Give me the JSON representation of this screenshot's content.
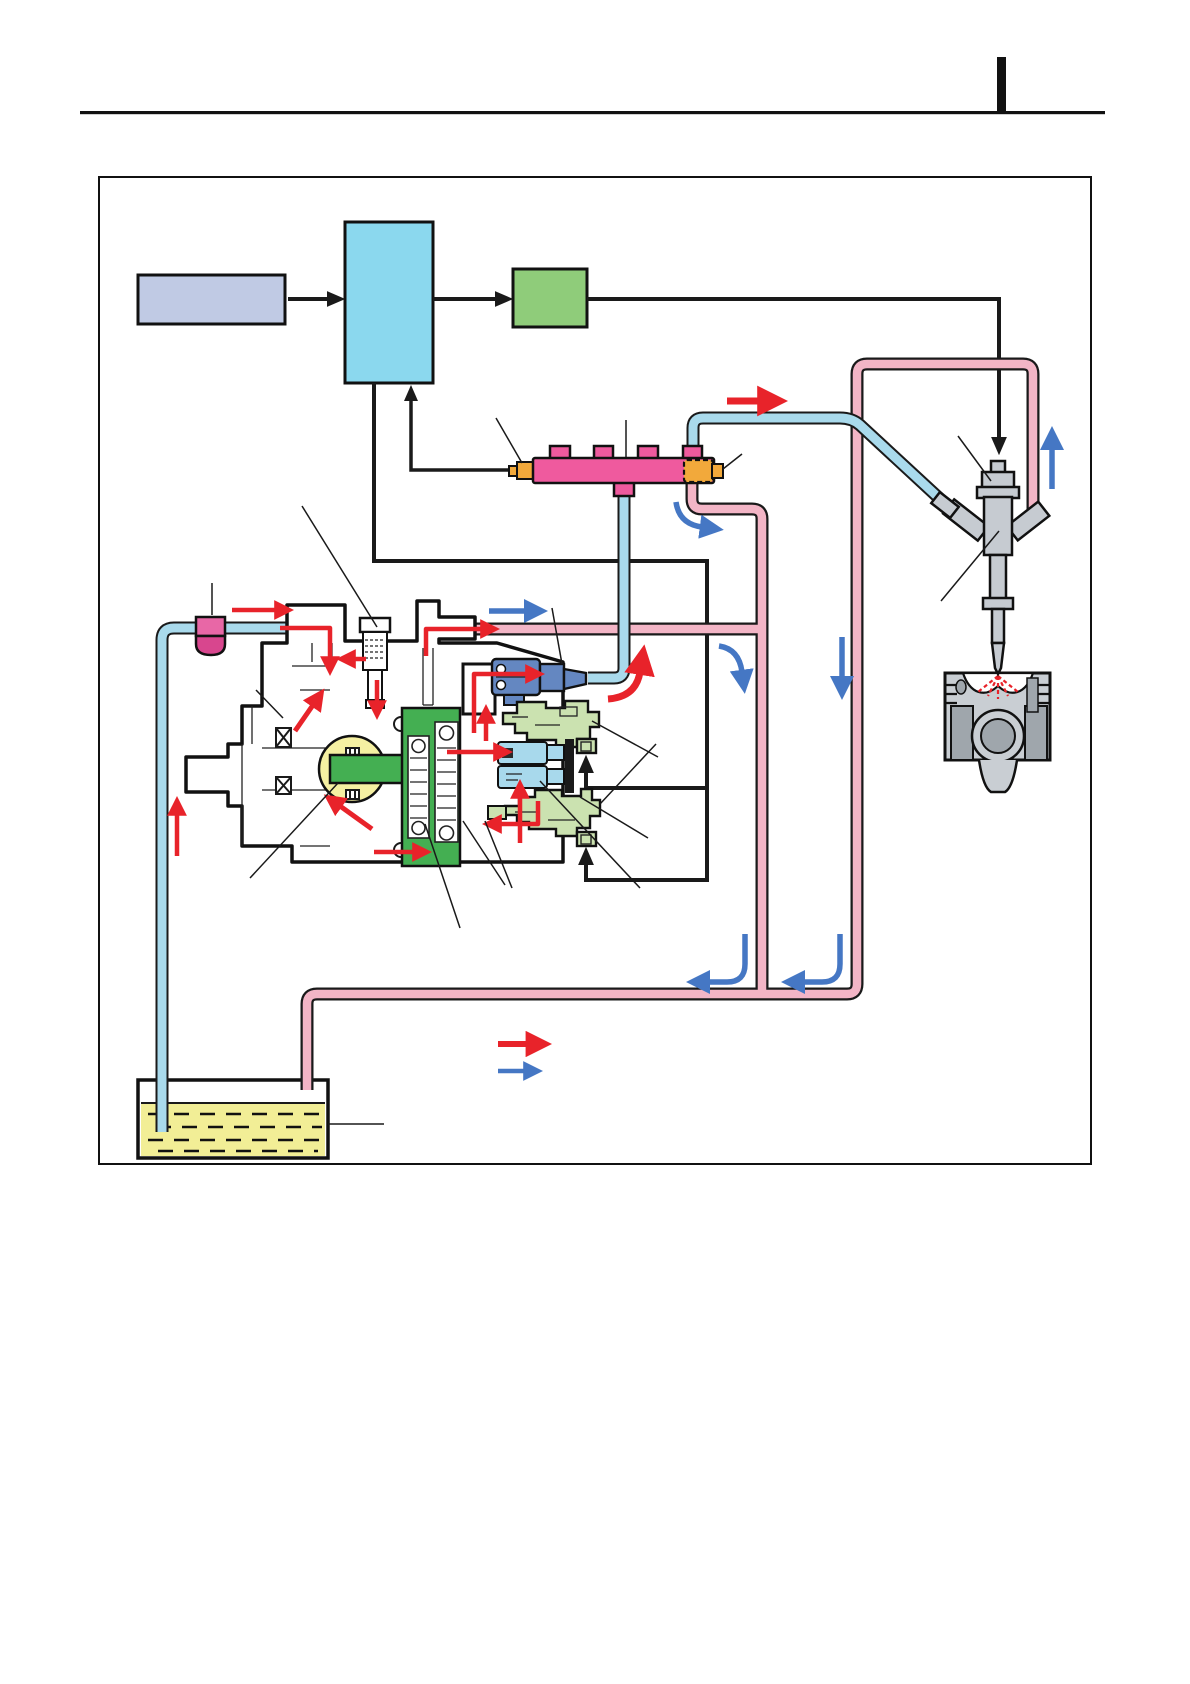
{
  "page": {
    "type": "service-manual-page-with-fuel-system-diagram",
    "background": "#ffffff",
    "has_visible_text": false,
    "header": {
      "rule": true,
      "margin_tab_bar": true
    }
  },
  "colors": {
    "ink": "#1a1a1a",
    "red": "#e8232a",
    "blue": "#4577c4",
    "pipe-pink": "#f3b5c6",
    "pipe-cyan": "#a9daec",
    "rail-pink": "#ef5a9e",
    "connector-orange": "#f2a93b",
    "ecu-cyan": "#8bd8ee",
    "input-box-periwinkle": "#c0cae4",
    "driver-box-green": "#8fcc7a",
    "pump-body-green": "#44af52",
    "cam-yellow": "#f5f0a2",
    "scv-blue": "#6487c1",
    "valve-block-green": "#cbe2b0",
    "cylinder-light-blue": "#a8d9ec",
    "fuel-yellow": "#f2ee96",
    "filter-pink-top": "#e867a6",
    "filter-pink-bottom": "#d8468e",
    "metal-light": "#c9ced3",
    "metal-dark": "#9fa6ac",
    "injector-gray": "#c6cbd1",
    "bg": "#ffffff"
  },
  "diagram": {
    "block_row": [
      "input-box",
      "control-unit-box",
      "driver-box"
    ],
    "components": [
      "common-rail-with-pressure-sensor-and-pressure-limiter",
      "high-pressure-supply-pump-cutaway",
      "suction-control-valve",
      "feed-pump-camshaft",
      "plunger-assemblies",
      "delivery-valve-blocks",
      "pre-filter",
      "fuel-tank",
      "injector",
      "piston-and-cylinder"
    ],
    "flow_arrows": {
      "red_supply_arrows": 17,
      "blue_return_arrows": 9,
      "black_signal_arrows": 7
    },
    "legend": {
      "entries": [
        {
          "symbol": "red-right-arrow"
        },
        {
          "symbol": "blue-right-arrow"
        }
      ]
    }
  }
}
